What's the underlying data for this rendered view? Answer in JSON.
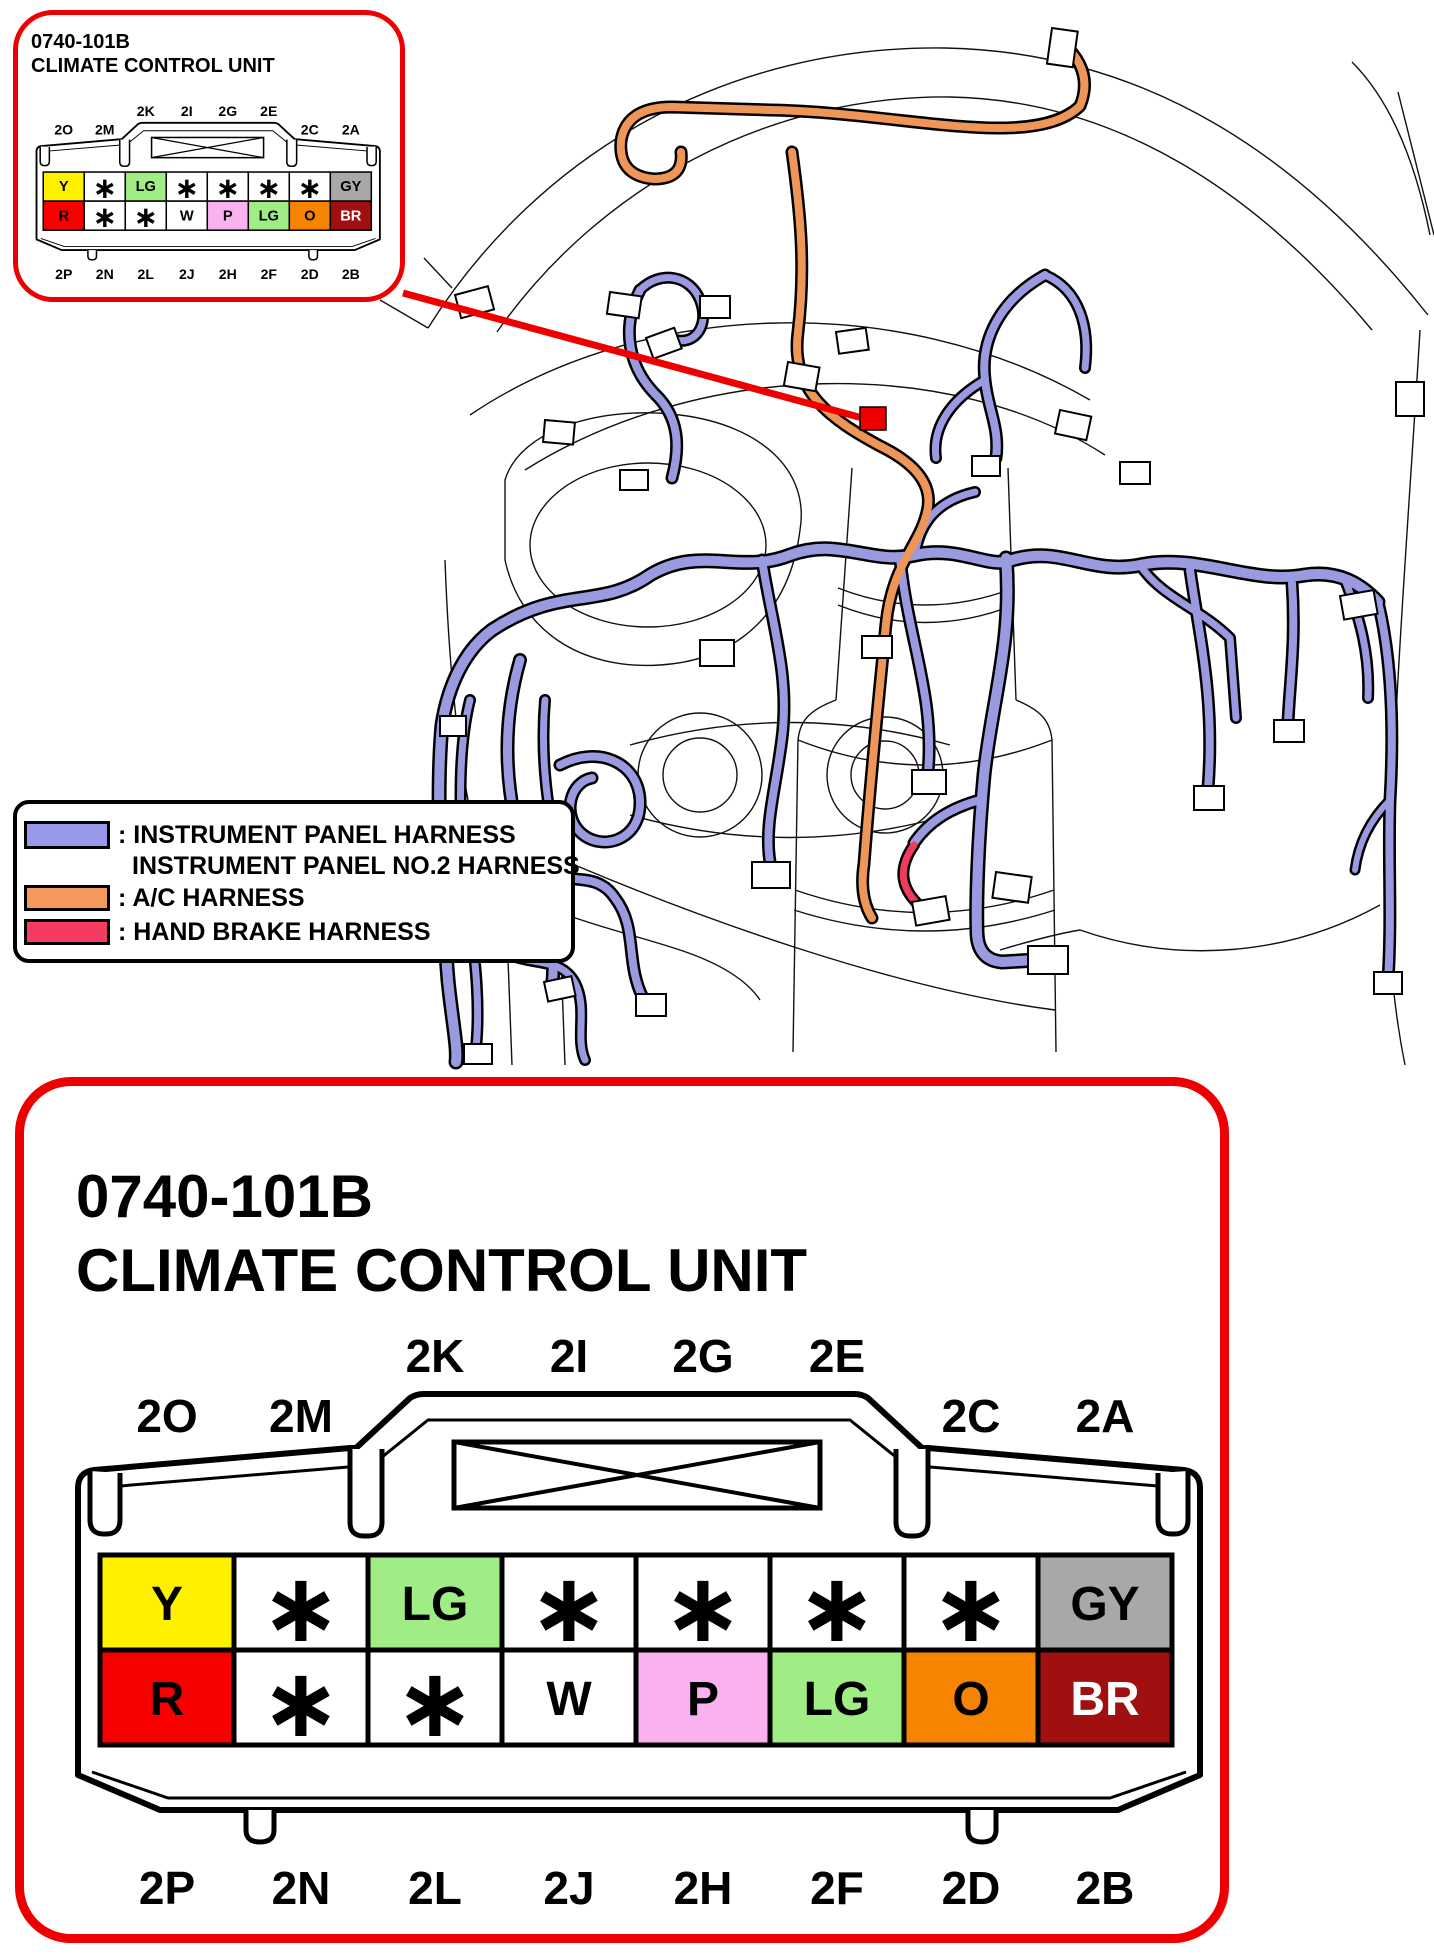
{
  "inset": {
    "part_number": "0740-101B",
    "title": "CLIMATE CONTROL UNIT"
  },
  "detail": {
    "part_number": "0740-101B",
    "title": "CLIMATE CONTROL UNIT"
  },
  "connector": {
    "pins_top": [
      {
        "label": "2O",
        "row": "low"
      },
      {
        "label": "2M",
        "row": "low"
      },
      {
        "label": "2K",
        "row": "high"
      },
      {
        "label": "2I",
        "row": "high"
      },
      {
        "label": "2G",
        "row": "high"
      },
      {
        "label": "2E",
        "row": "high"
      },
      {
        "label": "2C",
        "row": "low"
      },
      {
        "label": "2A",
        "row": "low"
      }
    ],
    "pins_bottom": [
      "2P",
      "2N",
      "2L",
      "2J",
      "2H",
      "2F",
      "2D",
      "2B"
    ],
    "cells": [
      [
        {
          "label": "Y",
          "color": "#FFF000"
        },
        {
          "label": "∗",
          "color": "#FFFFFF"
        },
        {
          "label": "LG",
          "color": "#A0EC85"
        },
        {
          "label": "∗",
          "color": "#FFFFFF"
        },
        {
          "label": "∗",
          "color": "#FFFFFF"
        },
        {
          "label": "∗",
          "color": "#FFFFFF"
        },
        {
          "label": "∗",
          "color": "#FFFFFF"
        },
        {
          "label": "GY",
          "color": "#A8A8A8"
        }
      ],
      [
        {
          "label": "R",
          "color": "#F90000"
        },
        {
          "label": "∗",
          "color": "#FFFFFF"
        },
        {
          "label": "∗",
          "color": "#FFFFFF"
        },
        {
          "label": "W",
          "color": "#FFFFFF"
        },
        {
          "label": "P",
          "color": "#F9B2EF"
        },
        {
          "label": "LG",
          "color": "#A0EC85"
        },
        {
          "label": "O",
          "color": "#F78400"
        },
        {
          "label": "BR",
          "color": "#A01010",
          "text": "#FFFFFF"
        }
      ]
    ]
  },
  "legend": {
    "items": [
      {
        "color": "#9999EC",
        "lines": [
          ": INSTRUMENT PANEL HARNESS",
          "INSTRUMENT PANEL NO.2 HARNESS"
        ]
      },
      {
        "color": "#F2995B",
        "lines": [
          ": A/C HARNESS"
        ]
      },
      {
        "color": "#F43C62",
        "lines": [
          ": HAND BRAKE HARNESS"
        ]
      }
    ]
  },
  "colors": {
    "callout_red": "#EE0000",
    "harness_purple": "#9A9AE0",
    "harness_orange": "#EE9558",
    "harness_red": "#EE3B5F"
  }
}
